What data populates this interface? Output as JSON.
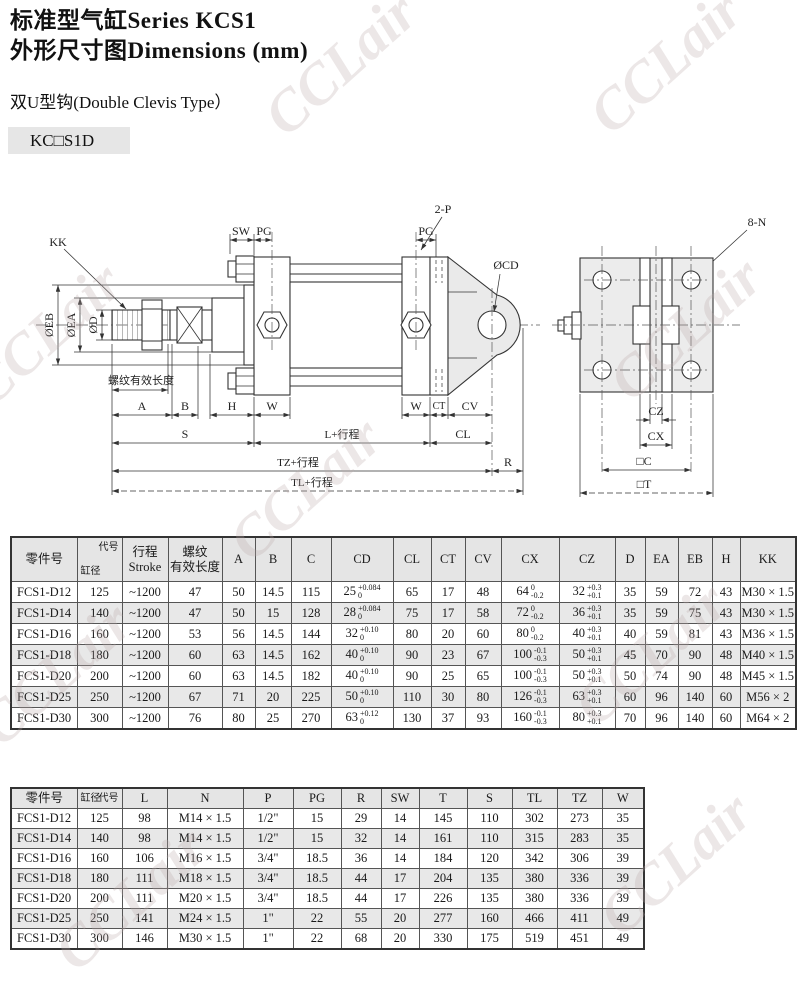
{
  "page": {
    "title_line1": "标准型气缸Series KCS1",
    "title_line2": "外形尺寸图Dimensions (mm)",
    "subtitle": "双U型钩(Double Clevis Type）",
    "model_code": "KC□S1D",
    "watermark": "CCLair",
    "watermark_color": "#dcd0d0",
    "table_header_bg": "#e5e5e5"
  },
  "drawing": {
    "labels": {
      "kk": "KK",
      "sw": "SW",
      "pg_front": "PG",
      "two_p": "2-P",
      "pg_rear": "PG",
      "cd": "ØCD",
      "eight_n": "8-N",
      "eb": "ØEB",
      "ea": "ØEA",
      "d": "ØD",
      "thread": "螺纹有效长度",
      "a": "A",
      "b": "B",
      "h": "H",
      "w_front": "W",
      "w_rear": "W",
      "ct": "CT",
      "cv": "CV",
      "s": "S",
      "l_plus": "L+行程",
      "cl": "CL",
      "tz_plus": "TZ+行程",
      "r": "R",
      "tl_plus": "TL+行程",
      "cz": "CZ",
      "cx": "CX",
      "c_square": "□C",
      "t_square": "□T"
    }
  },
  "table1": {
    "corner_top": "代号",
    "corner_bottom": "缸径",
    "headers": [
      "零件号",
      "@diag",
      "行程\nStroke",
      "螺纹\n有效长度",
      "A",
      "B",
      "C",
      "CD",
      "CL",
      "CT",
      "CV",
      "CX",
      "CZ",
      "D",
      "EA",
      "EB",
      "H",
      "KK"
    ],
    "rows": [
      [
        "FCS1-D12",
        "125",
        "~1200",
        "47",
        "50",
        "14.5",
        "115",
        {
          "v": "25",
          "s": "+0.084",
          "b": "0"
        },
        "65",
        "17",
        "48",
        {
          "v": "64",
          "s": "0",
          "b": "-0.2"
        },
        {
          "v": "32",
          "s": "+0.3",
          "b": "+0.1"
        },
        "35",
        "59",
        "72",
        "43",
        "M30 × 1.5"
      ],
      [
        "FCS1-D14",
        "140",
        "~1200",
        "47",
        "50",
        "15",
        "128",
        {
          "v": "28",
          "s": "+0.084",
          "b": "0"
        },
        "75",
        "17",
        "58",
        {
          "v": "72",
          "s": "0",
          "b": "-0.2"
        },
        {
          "v": "36",
          "s": "+0.3",
          "b": "+0.1"
        },
        "35",
        "59",
        "75",
        "43",
        "M30 × 1.5"
      ],
      [
        "FCS1-D16",
        "160",
        "~1200",
        "53",
        "56",
        "14.5",
        "144",
        {
          "v": "32",
          "s": "+0.10",
          "b": "0"
        },
        "80",
        "20",
        "60",
        {
          "v": "80",
          "s": "0",
          "b": "-0.2"
        },
        {
          "v": "40",
          "s": "+0.3",
          "b": "+0.1"
        },
        "40",
        "59",
        "81",
        "43",
        "M36 × 1.5"
      ],
      [
        "FCS1-D18",
        "180",
        "~1200",
        "60",
        "63",
        "14.5",
        "162",
        {
          "v": "40",
          "s": "+0.10",
          "b": "0"
        },
        "90",
        "23",
        "67",
        {
          "v": "100",
          "s": "-0.1",
          "b": "-0.3"
        },
        {
          "v": "50",
          "s": "+0.3",
          "b": "+0.1"
        },
        "45",
        "70",
        "90",
        "48",
        "M40 × 1.5"
      ],
      [
        "FCS1-D20",
        "200",
        "~1200",
        "60",
        "63",
        "14.5",
        "182",
        {
          "v": "40",
          "s": "+0.10",
          "b": "0"
        },
        "90",
        "25",
        "65",
        {
          "v": "100",
          "s": "-0.1",
          "b": "-0.3"
        },
        {
          "v": "50",
          "s": "+0.3",
          "b": "+0.1"
        },
        "50",
        "74",
        "90",
        "48",
        "M45 × 1.5"
      ],
      [
        "FCS1-D25",
        "250",
        "~1200",
        "67",
        "71",
        "20",
        "225",
        {
          "v": "50",
          "s": "+0.10",
          "b": "0"
        },
        "110",
        "30",
        "80",
        {
          "v": "126",
          "s": "-0.1",
          "b": "-0.3"
        },
        {
          "v": "63",
          "s": "+0.3",
          "b": "+0.1"
        },
        "60",
        "96",
        "140",
        "60",
        "M56 × 2"
      ],
      [
        "FCS1-D30",
        "300",
        "~1200",
        "76",
        "80",
        "25",
        "270",
        {
          "v": "63",
          "s": "+0.12",
          "b": "0"
        },
        "130",
        "37",
        "93",
        {
          "v": "160",
          "s": "-0.1",
          "b": "-0.3"
        },
        {
          "v": "80",
          "s": "+0.3",
          "b": "+0.1"
        },
        "70",
        "96",
        "140",
        "60",
        "M64 × 2"
      ]
    ]
  },
  "table2": {
    "corner_top": "代号",
    "corner_bottom": "缸径",
    "headers": [
      "零件号",
      "@diag",
      "L",
      "N",
      "P",
      "PG",
      "R",
      "SW",
      "T",
      "S",
      "TL",
      "TZ",
      "W"
    ],
    "rows": [
      [
        "FCS1-D12",
        "125",
        "98",
        "M14 × 1.5",
        "1/2\"",
        "15",
        "29",
        "14",
        "145",
        "110",
        "302",
        "273",
        "35"
      ],
      [
        "FCS1-D14",
        "140",
        "98",
        "M14 × 1.5",
        "1/2\"",
        "15",
        "32",
        "14",
        "161",
        "110",
        "315",
        "283",
        "35"
      ],
      [
        "FCS1-D16",
        "160",
        "106",
        "M16 × 1.5",
        "3/4\"",
        "18.5",
        "36",
        "14",
        "184",
        "120",
        "342",
        "306",
        "39"
      ],
      [
        "FCS1-D18",
        "180",
        "111",
        "M18 × 1.5",
        "3/4\"",
        "18.5",
        "44",
        "17",
        "204",
        "135",
        "380",
        "336",
        "39"
      ],
      [
        "FCS1-D20",
        "200",
        "111",
        "M20 × 1.5",
        "3/4\"",
        "18.5",
        "44",
        "17",
        "226",
        "135",
        "380",
        "336",
        "39"
      ],
      [
        "FCS1-D25",
        "250",
        "141",
        "M24 × 1.5",
        "1\"",
        "22",
        "55",
        "20",
        "277",
        "160",
        "466",
        "411",
        "49"
      ],
      [
        "FCS1-D30",
        "300",
        "146",
        "M30 × 1.5",
        "1\"",
        "22",
        "68",
        "20",
        "330",
        "175",
        "519",
        "451",
        "49"
      ]
    ]
  }
}
